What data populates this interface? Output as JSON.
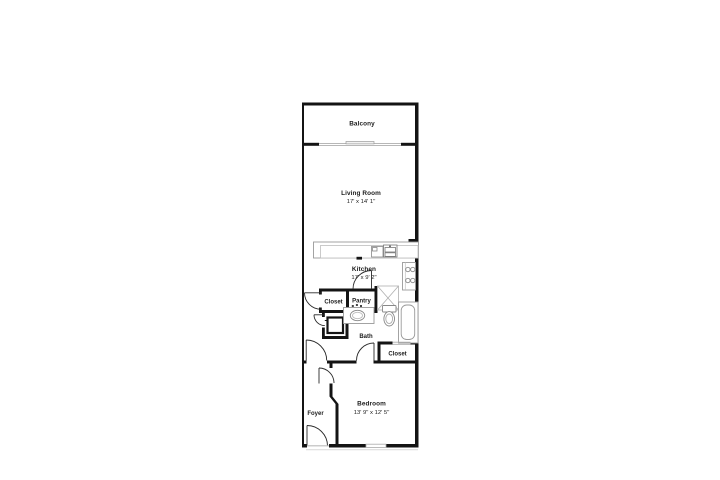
{
  "floor_plan": {
    "background": "#ffffff",
    "wall_color": "#141414",
    "fixture_color": "#999999",
    "rooms": {
      "balcony": {
        "name": "Balcony"
      },
      "living_room": {
        "name": "Living Room",
        "dims": "17' x 14' 1\""
      },
      "kitchen": {
        "name": "Kitchen",
        "dims": "17' x 9' 2\""
      },
      "closet_upper": {
        "name": "Closet"
      },
      "pantry": {
        "name": "Pantry"
      },
      "bath": {
        "name": "Bath"
      },
      "closet_lower": {
        "name": "Closet"
      },
      "bedroom": {
        "name": "Bedroom",
        "dims": "13' 9\" x 12' 5\""
      },
      "foyer": {
        "name": "Foyer"
      }
    }
  }
}
